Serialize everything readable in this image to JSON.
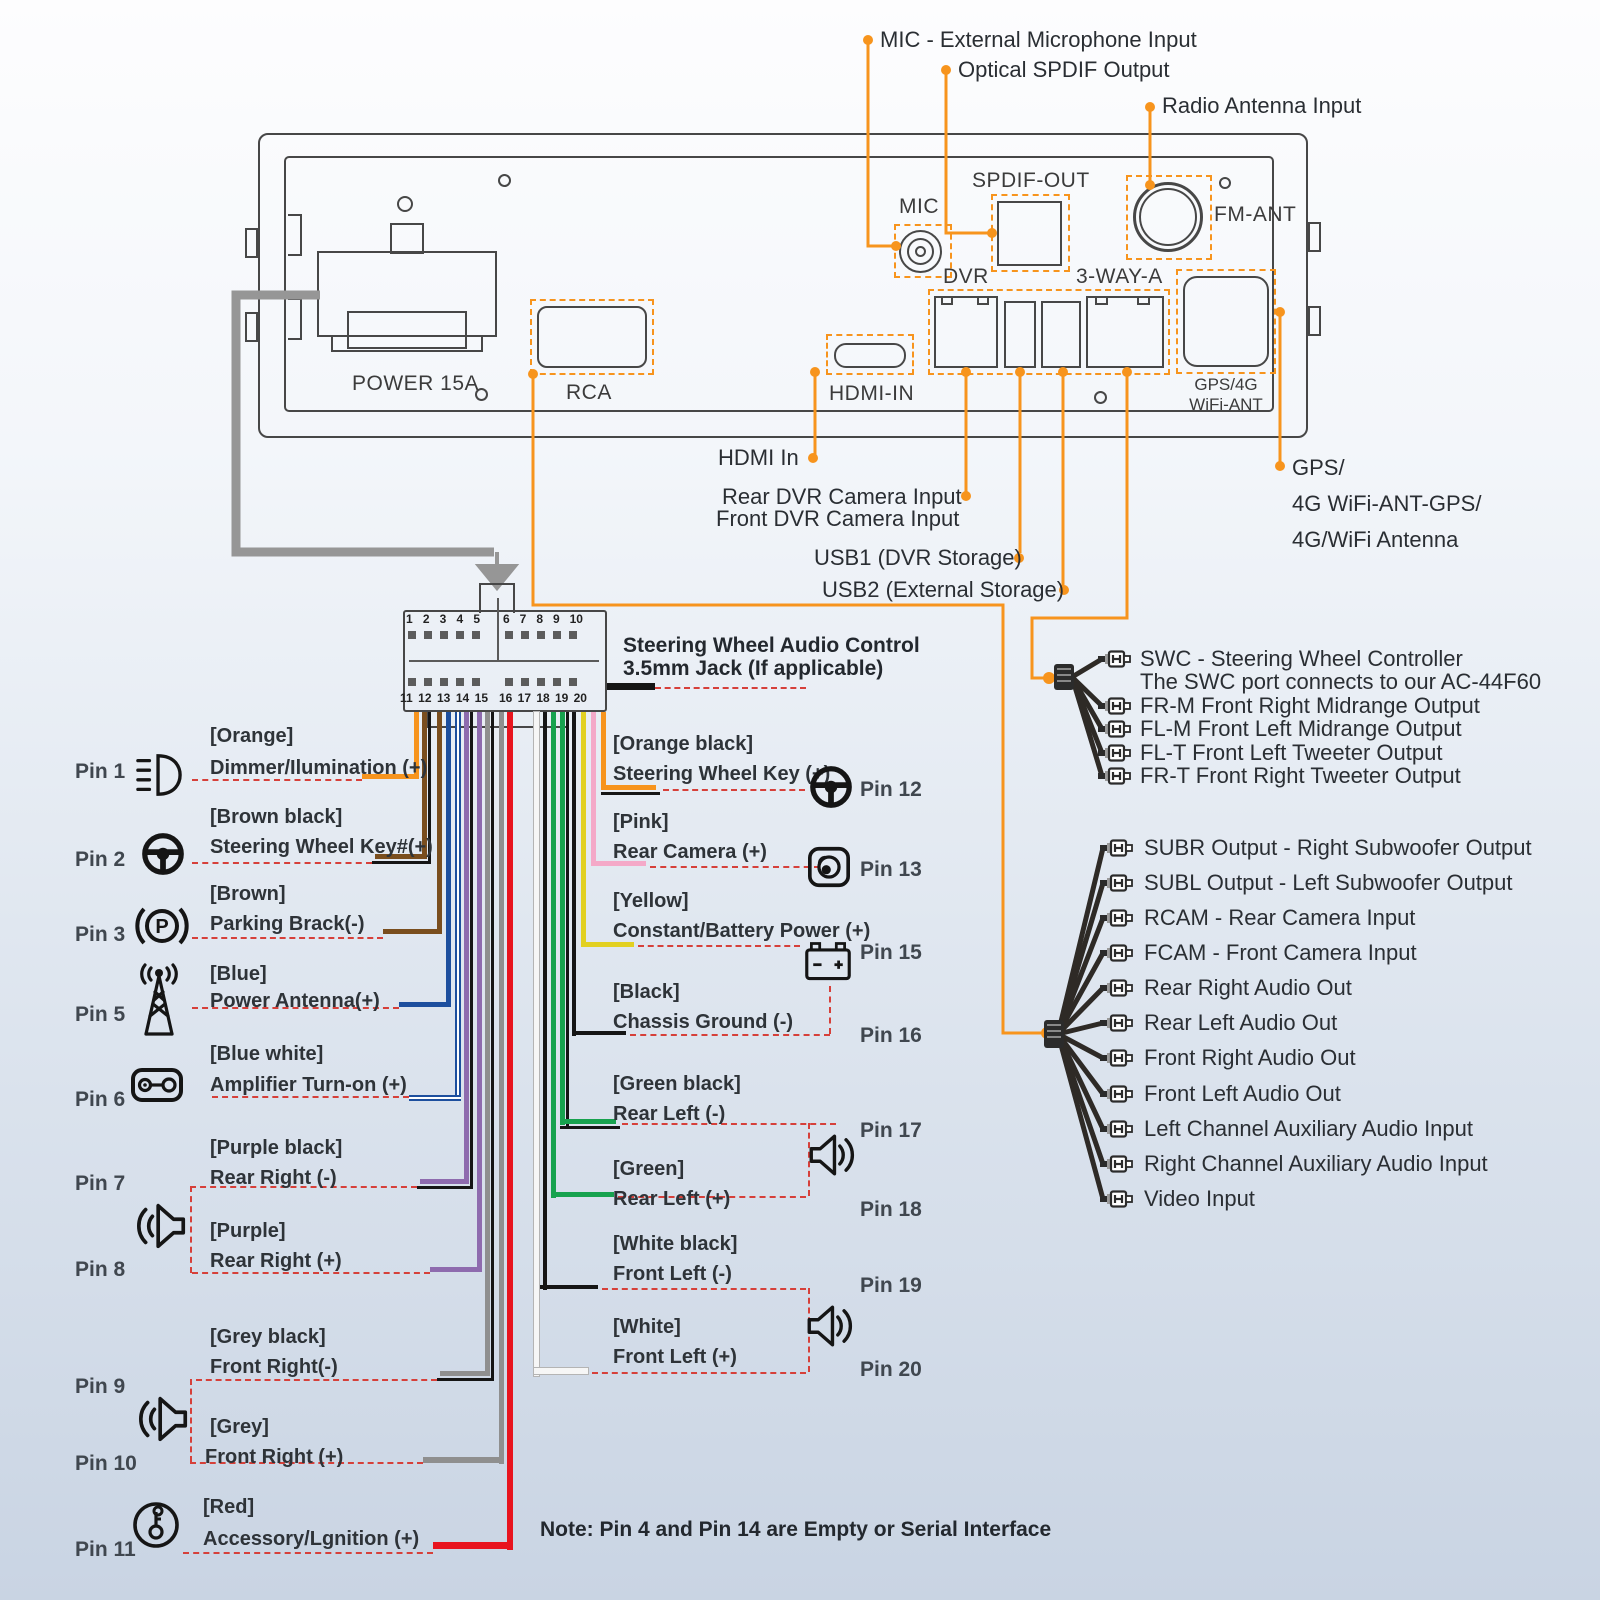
{
  "top_callouts": {
    "mic": "MIC - External Microphone Input",
    "spdif": "Optical SPDIF Output",
    "radio": "Radio Antenna Input"
  },
  "panel": {
    "power": "POWER 15A",
    "rca": "RCA",
    "hdmi": "HDMI-IN",
    "mic": "MIC",
    "spdif_out": "SPDIF-OUT",
    "dvr": "DVR",
    "three_way": "3-WAY-A",
    "fm_ant": "FM-ANT",
    "gps_line1": "GPS/4G",
    "gps_line2": "WiFi-ANT"
  },
  "bottom_callouts": {
    "hdmi_in": "HDMI In",
    "rear_dvr": "Rear DVR Camera Input",
    "front_dvr": "Front DVR Camera Input",
    "usb1": "USB1 (DVR Storage)",
    "usb2": "USB2 (External Storage)",
    "gps1": "GPS/",
    "gps2": "4G WiFi-ANT-GPS/",
    "gps3": "4G/WiFi Antenna"
  },
  "harness": {
    "title_line1": "Steering Wheel Audio Control",
    "title_line2": "3.5mm Jack (If applicable)",
    "pins_top": [
      "1",
      "2",
      "3",
      "4",
      "5",
      "6",
      "7",
      "8",
      "9",
      "10"
    ],
    "pins_bottom": [
      "11",
      "12",
      "13",
      "14",
      "15",
      "16",
      "17",
      "18",
      "19",
      "20"
    ]
  },
  "left_pins": [
    {
      "pin": "Pin 1",
      "tag": "[Orange]",
      "label": "Dimmer/Ilumination (+)",
      "icon": "headlight-icon",
      "wire_color": "#F7941D"
    },
    {
      "pin": "Pin 2",
      "tag": "[Brown black]",
      "label": "Steering Wheel Key#(+)",
      "icon": "steering-wheel-icon",
      "wire_color": "#7A4E1E"
    },
    {
      "pin": "Pin 3",
      "tag": "[Brown]",
      "label": "Parking Brack(-)",
      "icon": "parking-brake-icon",
      "wire_color": "#7A4E1E"
    },
    {
      "pin": "Pin 5",
      "tag": "[Blue]",
      "label": "Power Antenna(+)",
      "icon": "antenna-icon",
      "wire_color": "#1D4F9E"
    },
    {
      "pin": "Pin 6",
      "tag": "[Blue white]",
      "label": "Amplifier Turn-on (+)",
      "icon": "amplifier-icon",
      "wire_color": "#1D4F9E"
    },
    {
      "pin": "Pin 7",
      "tag": "[Purple black]",
      "label": "Rear Right (-)",
      "icon": "speaker-icon",
      "wire_color": "#8E6BAE"
    },
    {
      "pin": "Pin 8",
      "tag": "[Purple]",
      "label": "Rear Right (+)",
      "icon": "speaker-icon",
      "wire_color": "#8E6BAE"
    },
    {
      "pin": "Pin 9",
      "tag": "[Grey black]",
      "label": "Front Right(-)",
      "icon": "speaker-icon",
      "wire_color": "#8F8F8F"
    },
    {
      "pin": "Pin 10",
      "tag": "[Grey]",
      "label": "Front Right (+)",
      "icon": "speaker-icon",
      "wire_color": "#8F8F8F"
    },
    {
      "pin": "Pin 11",
      "tag": "[Red]",
      "label": "Accessory/Lgnition (+)",
      "icon": "ignition-key-icon",
      "wire_color": "#E8141E"
    }
  ],
  "right_pins": [
    {
      "pin": "Pin 12",
      "tag": "[Orange black]",
      "label": "Steering Wheel Key (+)",
      "icon": "steering-wheel-icon",
      "wire_color": "#F7941D"
    },
    {
      "pin": "Pin 13",
      "tag": "[Pink]",
      "label": "Rear Camera (+)",
      "icon": "camera-icon",
      "wire_color": "#F4A9C8"
    },
    {
      "pin": "Pin 15",
      "tag": "[Yellow]",
      "label": "Constant/Battery Power (+)",
      "icon": "battery-icon",
      "wire_color": "#E2D021"
    },
    {
      "pin": "Pin 16",
      "tag": "[Black]",
      "label": "Chassis Ground (-)",
      "icon": "battery-icon",
      "wire_color": "#151515"
    },
    {
      "pin": "Pin 17",
      "tag": "[Green black]",
      "label": "Rear Left (-)",
      "icon": "speaker-icon",
      "wire_color": "#17A24E"
    },
    {
      "pin": "Pin 18",
      "tag": "[Green]",
      "label": "Rear Left (+)",
      "icon": "speaker-icon",
      "wire_color": "#17A24E"
    },
    {
      "pin": "Pin 19",
      "tag": "[White black]",
      "label": "Front Left (-)",
      "icon": "speaker-icon",
      "wire_color": "#f6f6f6"
    },
    {
      "pin": "Pin 20",
      "tag": "[White]",
      "label": "Front Left (+)",
      "icon": "speaker-icon",
      "wire_color": "#f6f6f6"
    }
  ],
  "swc_outputs": {
    "line1": "SWC - Steering Wheel Controller",
    "line2": "The SWC port connects to our AC-44F60",
    "items": [
      "FR-M Front Right Midrange Output",
      "FL-M Front Left Midrange Output",
      "FL-T Front Left Tweeter Output",
      "FR-T Front Right Tweeter Output"
    ]
  },
  "rca_outputs": [
    "SUBR Output - Right Subwoofer Output",
    "SUBL Output - Left Subwoofer Output",
    "RCAM - Rear Camera Input",
    "FCAM - Front Camera Input",
    "Rear Right Audio Out",
    "Rear Left Audio Out",
    "Front Right Audio Out",
    "Front Left Audio Out",
    "Left Channel Auxiliary Audio Input",
    "Right Channel Auxiliary Audio Input",
    "Video Input"
  ],
  "note": "Note: Pin 4 and Pin 14 are Empty or Serial Interface",
  "colors": {
    "accent_orange": "#F7941D",
    "dash_red": "#D6403A",
    "feed_grey": "#969696",
    "wire_orange": "#F7941D",
    "wire_brown": "#7A4E1E",
    "wire_black": "#151515",
    "wire_blue": "#1D4F9E",
    "wire_purple": "#8E6BAE",
    "wire_grey": "#8F8F8F",
    "wire_red": "#E8141E",
    "wire_pink": "#F4A9C8",
    "wire_yellow": "#E2D021",
    "wire_green": "#17A24E",
    "wire_white": "#F6F6F6"
  }
}
